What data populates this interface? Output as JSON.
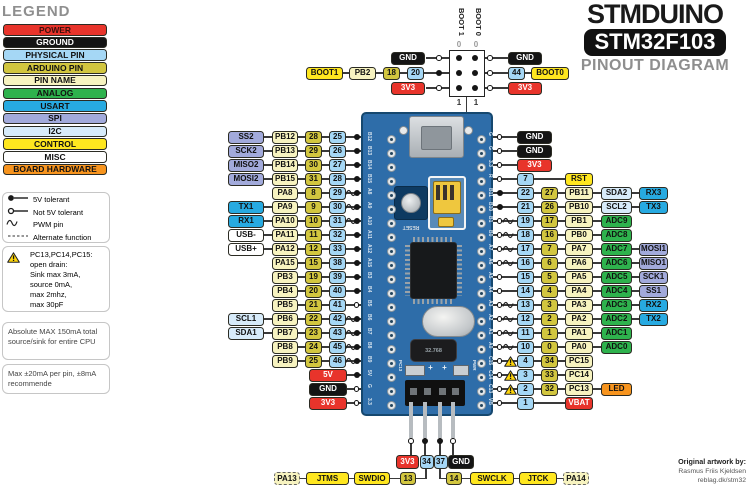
{
  "title": {
    "brand": "STMDUINO",
    "chip": "STM32F103",
    "subtitle": "PINOUT DIAGRAM"
  },
  "credit": {
    "line1": "Original artwork by:",
    "line2": "Rasmus Friis Kjeldsen",
    "line3": "reblag.dk/stm32"
  },
  "colors": {
    "power": "#E8342B",
    "ground": "#141414",
    "physical_pin": "#A5D7F5",
    "arduino_pin": "#D2C63F",
    "pin_name": "#F7F3C0",
    "analog": "#2EB24D",
    "usart": "#27AAE1",
    "spi": "#A2AADB",
    "i2c": "#D7EBFA",
    "control": "#FFE71F",
    "misc": "#FFFFFF",
    "board_hardware": "#F7941E",
    "pcb_blue": "#2E6DA9"
  },
  "legend": {
    "heading": "LEGEND",
    "swatches": [
      {
        "label": "POWER",
        "type": "power"
      },
      {
        "label": "GROUND",
        "type": "ground"
      },
      {
        "label": "PHYSICAL PIN",
        "type": "physical"
      },
      {
        "label": "ARDUINO  PIN",
        "type": "arduino"
      },
      {
        "label": "PIN NAME",
        "type": "pinname"
      },
      {
        "label": "ANALOG",
        "type": "analog"
      },
      {
        "label": "USART",
        "type": "usart"
      },
      {
        "label": "SPI",
        "type": "spi"
      },
      {
        "label": "I2C",
        "type": "i2c"
      },
      {
        "label": "CONTROL",
        "type": "control"
      },
      {
        "label": "MISC",
        "type": "misc"
      },
      {
        "label": "BOARD HARDWARE",
        "type": "hardware"
      }
    ],
    "symbols": [
      {
        "icon": "filled-dot",
        "label": "5V tolerant"
      },
      {
        "icon": "hollow-dot",
        "label": "Not 5V tolerant"
      },
      {
        "icon": "pwm",
        "label": "PWM pin"
      },
      {
        "icon": "dashed",
        "label": "Alternate function"
      }
    ],
    "warning_lines": [
      "PC13,PC14,PC15:",
      "open  drain:",
      "Sink max 3mA,",
      "source 0mA,",
      "max 2mhz,",
      "max 30pF"
    ],
    "notes": [
      "Absolute MAX 150mA total source/sink for entire CPU",
      "Max ±20mA per pin, ±8mA recommende"
    ]
  },
  "boot_top": {
    "left_chain": [
      {
        "label": "BOOT1",
        "type": "control"
      },
      {
        "label": "PB2",
        "type": "pinname"
      },
      {
        "label": "18",
        "type": "arduino"
      },
      {
        "label": "20",
        "type": "physical"
      }
    ],
    "left_top": {
      "label": "GND",
      "type": "ground"
    },
    "left_bottom": {
      "label": "3V3",
      "type": "power"
    },
    "jumper": {
      "col_labels": [
        "BOOT 1",
        "BOOT 0"
      ],
      "top_values": [
        "0",
        "0"
      ],
      "bottom_values": [
        "1",
        "1"
      ]
    },
    "right_top": {
      "label": "GND",
      "type": "ground"
    },
    "right_chain": [
      {
        "label": "44",
        "type": "physical"
      },
      {
        "label": "BOOT0",
        "type": "control"
      }
    ],
    "right_bottom": {
      "label": "3V3",
      "type": "power"
    }
  },
  "left_rows": [
    {
      "func": {
        "label": "SS2",
        "type": "spi"
      },
      "name": "PB12",
      "arduino": "28",
      "physical": "25",
      "pwm": false,
      "dot": "filled"
    },
    {
      "func": {
        "label": "SCK2",
        "type": "spi"
      },
      "name": "PB13",
      "arduino": "29",
      "physical": "26",
      "pwm": false,
      "dot": "filled"
    },
    {
      "func": {
        "label": "MISO2",
        "type": "spi"
      },
      "name": "PB14",
      "arduino": "30",
      "physical": "27",
      "pwm": false,
      "dot": "filled"
    },
    {
      "func": {
        "label": "MOSI2",
        "type": "spi"
      },
      "name": "PB15",
      "arduino": "31",
      "physical": "28",
      "pwm": false,
      "dot": "filled"
    },
    {
      "func": null,
      "name": "PA8",
      "arduino": "8",
      "physical": "29",
      "pwm": true,
      "dot": "filled"
    },
    {
      "func": {
        "label": "TX1",
        "type": "usart"
      },
      "name": "PA9",
      "arduino": "9",
      "physical": "30",
      "pwm": true,
      "dot": "filled"
    },
    {
      "func": {
        "label": "RX1",
        "type": "usart"
      },
      "name": "PA10",
      "arduino": "10",
      "physical": "31",
      "pwm": true,
      "dot": "filled"
    },
    {
      "func": {
        "label": "USB-",
        "type": "misc"
      },
      "name": "PA11",
      "arduino": "11",
      "physical": "32",
      "pwm": false,
      "dot": "filled"
    },
    {
      "func": {
        "label": "USB+",
        "type": "misc"
      },
      "name": "PA12",
      "arduino": "12",
      "physical": "33",
      "pwm": false,
      "dot": "filled"
    },
    {
      "func": null,
      "name": "PA15",
      "arduino": "15",
      "physical": "38",
      "pwm": false,
      "dot": "filled"
    },
    {
      "func": null,
      "name": "PB3",
      "arduino": "19",
      "physical": "39",
      "pwm": false,
      "dot": "filled"
    },
    {
      "func": null,
      "name": "PB4",
      "arduino": "20",
      "physical": "40",
      "pwm": false,
      "dot": "filled"
    },
    {
      "func": null,
      "name": "PB5",
      "arduino": "21",
      "physical": "41",
      "pwm": false,
      "dot": "hollow"
    },
    {
      "func": {
        "label": "SCL1",
        "type": "i2c"
      },
      "name": "PB6",
      "arduino": "22",
      "physical": "42",
      "pwm": true,
      "dot": "filled"
    },
    {
      "func": {
        "label": "SDA1",
        "type": "i2c"
      },
      "name": "PB7",
      "arduino": "23",
      "physical": "43",
      "pwm": true,
      "dot": "filled"
    },
    {
      "func": null,
      "name": "PB8",
      "arduino": "24",
      "physical": "45",
      "pwm": true,
      "dot": "filled"
    },
    {
      "func": null,
      "name": "PB9",
      "arduino": "25",
      "physical": "46",
      "pwm": true,
      "dot": "filled"
    },
    {
      "power": {
        "label": "5V",
        "type": "power"
      },
      "dot": "filled"
    },
    {
      "power": {
        "label": "GND",
        "type": "ground"
      },
      "dot": "hollow"
    },
    {
      "power": {
        "label": "3V3",
        "type": "power"
      },
      "dot": "hollow"
    }
  ],
  "right_rows": [
    {
      "power": {
        "label": "GND",
        "type": "ground"
      },
      "dot": "hollow"
    },
    {
      "power": {
        "label": "GND",
        "type": "ground"
      },
      "dot": "hollow"
    },
    {
      "power": {
        "label": "3V3",
        "type": "power"
      },
      "dot": "hollow"
    },
    {
      "physical": "7",
      "name": {
        "label": "RST",
        "type": "control"
      },
      "dot": "hollow"
    },
    {
      "physical": "22",
      "arduino": "27",
      "name": {
        "label": "PB11",
        "type": "pinname"
      },
      "analog": {
        "label": "SDA2",
        "type": "i2c"
      },
      "func": {
        "label": "RX3",
        "type": "usart"
      },
      "dot": "filled"
    },
    {
      "physical": "21",
      "arduino": "26",
      "name": {
        "label": "PB10",
        "type": "pinname"
      },
      "analog": {
        "label": "SCL2",
        "type": "i2c"
      },
      "func": {
        "label": "TX3",
        "type": "usart"
      },
      "dot": "filled"
    },
    {
      "physical": "19",
      "arduino": "17",
      "name": {
        "label": "PB1",
        "type": "pinname"
      },
      "analog": {
        "label": "ADC9",
        "type": "analog"
      },
      "pwm": true,
      "dot": "hollow"
    },
    {
      "physical": "18",
      "arduino": "16",
      "name": {
        "label": "PB0",
        "type": "pinname"
      },
      "analog": {
        "label": "ADC8",
        "type": "analog"
      },
      "pwm": true,
      "dot": "hollow"
    },
    {
      "physical": "17",
      "arduino": "7",
      "name": {
        "label": "PA7",
        "type": "pinname"
      },
      "analog": {
        "label": "ADC7",
        "type": "analog"
      },
      "func": {
        "label": "MOSI1",
        "type": "spi"
      },
      "pwm": true,
      "dot": "hollow"
    },
    {
      "physical": "16",
      "arduino": "6",
      "name": {
        "label": "PA6",
        "type": "pinname"
      },
      "analog": {
        "label": "ADC6",
        "type": "analog"
      },
      "func": {
        "label": "MISO1",
        "type": "spi"
      },
      "pwm": true,
      "dot": "hollow"
    },
    {
      "physical": "15",
      "arduino": "5",
      "name": {
        "label": "PA5",
        "type": "pinname"
      },
      "analog": {
        "label": "ADC5",
        "type": "analog"
      },
      "func": {
        "label": "SCK1",
        "type": "spi"
      },
      "pwm": false,
      "dot": "hollow"
    },
    {
      "physical": "14",
      "arduino": "4",
      "name": {
        "label": "PA4",
        "type": "pinname"
      },
      "analog": {
        "label": "ADC4",
        "type": "analog"
      },
      "func": {
        "label": "SS1",
        "type": "spi"
      },
      "pwm": false,
      "dot": "hollow"
    },
    {
      "physical": "13",
      "arduino": "3",
      "name": {
        "label": "PA3",
        "type": "pinname"
      },
      "analog": {
        "label": "ADC3",
        "type": "analog"
      },
      "func": {
        "label": "RX2",
        "type": "usart"
      },
      "pwm": true,
      "dot": "hollow"
    },
    {
      "physical": "12",
      "arduino": "2",
      "name": {
        "label": "PA2",
        "type": "pinname"
      },
      "analog": {
        "label": "ADC2",
        "type": "analog"
      },
      "func": {
        "label": "TX2",
        "type": "usart"
      },
      "pwm": true,
      "dot": "hollow"
    },
    {
      "physical": "11",
      "arduino": "1",
      "name": {
        "label": "PA1",
        "type": "pinname"
      },
      "analog": {
        "label": "ADC1",
        "type": "analog"
      },
      "pwm": true,
      "dot": "hollow"
    },
    {
      "physical": "10",
      "arduino": "0",
      "name": {
        "label": "PA0",
        "type": "pinname"
      },
      "analog": {
        "label": "ADC0",
        "type": "analog"
      },
      "pwm": true,
      "dot": "hollow"
    },
    {
      "physical": "4",
      "arduino": "34",
      "name": {
        "label": "PC15",
        "type": "pinname"
      },
      "warn": true,
      "dot": "hollow"
    },
    {
      "physical": "3",
      "arduino": "33",
      "name": {
        "label": "PC14",
        "type": "pinname"
      },
      "warn": true,
      "dot": "hollow"
    },
    {
      "physical": "2",
      "arduino": "32",
      "name": {
        "label": "PC13",
        "type": "pinname"
      },
      "analog": {
        "label": "LED",
        "type": "hardware"
      },
      "warn": true,
      "dot": "hollow"
    },
    {
      "physical": "1",
      "name": {
        "label": "VBAT",
        "type": "power"
      },
      "dot": "hollow"
    }
  ],
  "bottom": {
    "pins": [
      {
        "label": "3V3",
        "type": "power",
        "dot": "hollow"
      },
      {
        "label": "34",
        "type": "physical",
        "dot": "filled"
      },
      {
        "label": "37",
        "type": "physical",
        "dot": "filled"
      },
      {
        "label": "GND",
        "type": "ground",
        "dot": "hollow"
      }
    ],
    "left_group": [
      {
        "label": "PA13",
        "type": "pinname",
        "alt": true
      },
      {
        "label": "JTMS",
        "type": "control"
      },
      {
        "label": "SWDIO",
        "type": "control"
      },
      {
        "label": "13",
        "type": "arduino"
      }
    ],
    "right_group": [
      {
        "label": "14",
        "type": "arduino"
      },
      {
        "label": "SWCLK",
        "type": "control"
      },
      {
        "label": "JTCK",
        "type": "control"
      },
      {
        "label": "PA14",
        "type": "pinname",
        "alt": true
      }
    ]
  },
  "board": {
    "left_silk": [
      "B12",
      "B13",
      "B14",
      "B15",
      "A8",
      "A9",
      "A10",
      "A11",
      "A12",
      "A15",
      "B3",
      "B4",
      "B5",
      "B6",
      "B7",
      "B8",
      "B9",
      "5V",
      "G",
      "3.3"
    ],
    "right_silk": [
      "G",
      "G",
      "3.3",
      "R",
      "B11",
      "B10",
      "B1",
      "B0",
      "A7",
      "A6",
      "A5",
      "A4",
      "A3",
      "A2",
      "A1",
      "A0",
      "C15",
      "C14",
      "C13",
      "VB"
    ],
    "reset_label": "RESET",
    "crystal_label": "32.768",
    "led_left_label": "PC13",
    "led_right_label": "PWR",
    "plus_mark": "+"
  }
}
